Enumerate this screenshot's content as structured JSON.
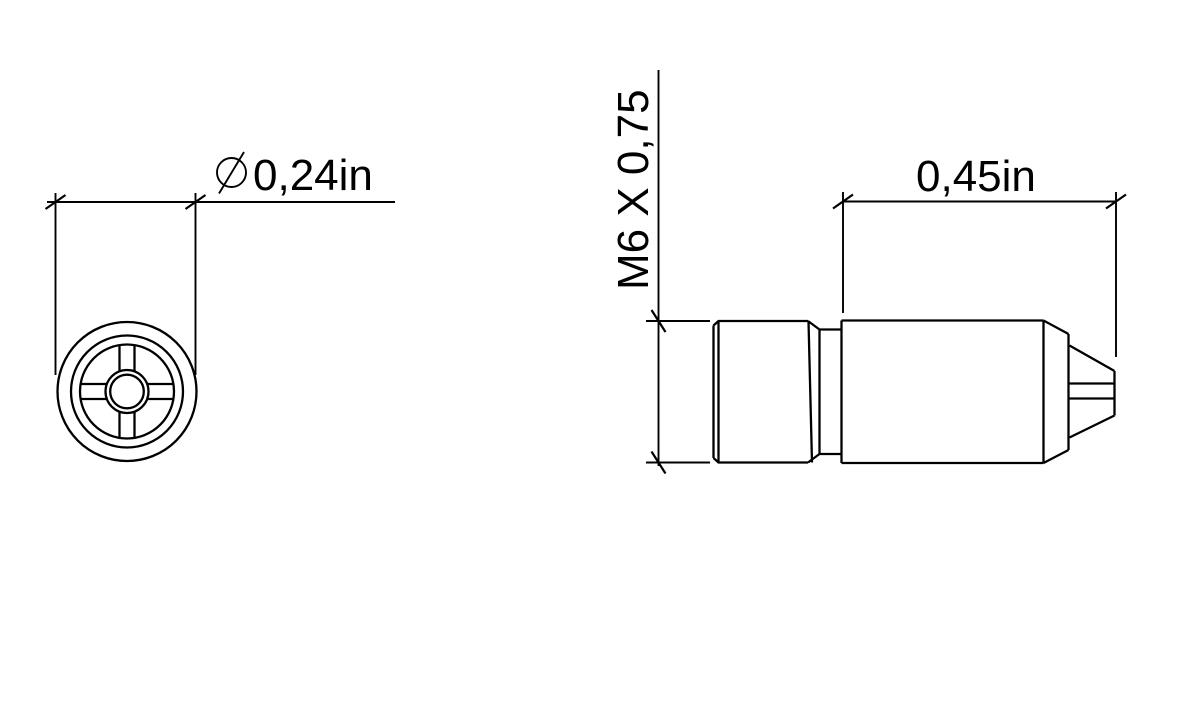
{
  "drawing": {
    "background_color": "#ffffff",
    "line_color": "#000000"
  },
  "front_view": {
    "diameter_dimension": {
      "symbol": "⌀",
      "value": "0,24in"
    }
  },
  "side_view": {
    "thread_dimension": {
      "value": "M6 X 0,75"
    },
    "length_dimension": {
      "value": "0,45in"
    }
  }
}
